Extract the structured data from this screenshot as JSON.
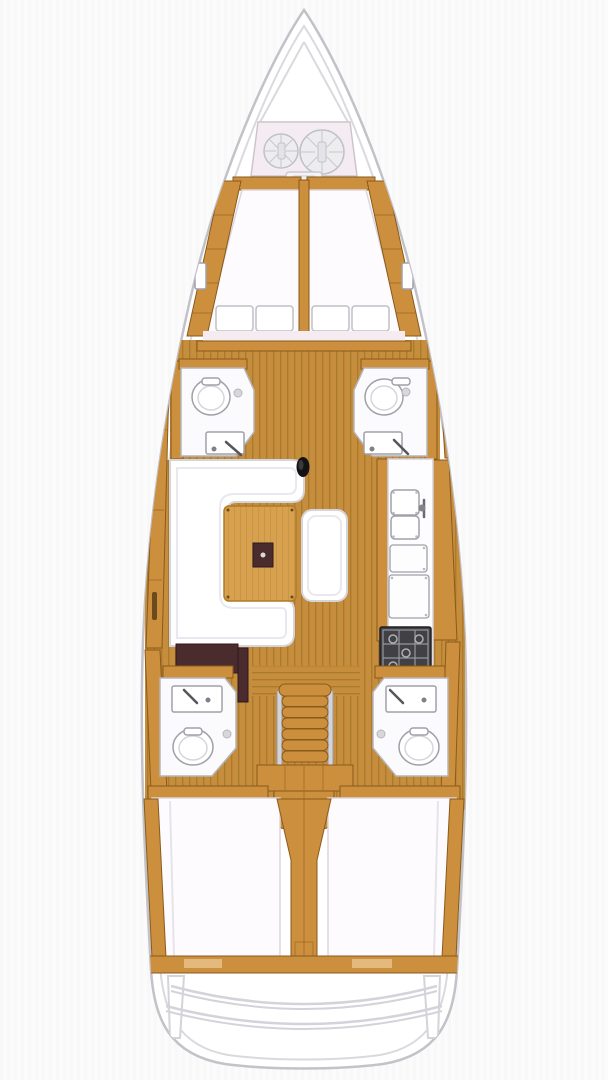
{
  "meta": {
    "label": "Sailboat interior deck plan, top-down view",
    "view": "overhead floor plan",
    "vessel_type": "sailing yacht monohull"
  },
  "colors": {
    "hull_stroke": "#c2c2c8",
    "inner_hull_line": "#d9d9de",
    "wood_trim": "#cc8f3d",
    "wood_dark": "#8a5a1a",
    "wood_light": "#e6c189",
    "floor_wood": "#c68e3c",
    "plank_line": "#a3762c",
    "table_wood": "#d7a150",
    "dark_panel": "#4a2b2e",
    "mattress_white": "#fdfbfd",
    "room_fill": "#fbfafc",
    "room_stroke": "#b5b5bd",
    "fixture_stroke": "#a0a0a8",
    "settee_stroke": "#d4d4da",
    "blush": "#f5ecf2",
    "metal": "#d3d3da",
    "stove_body": "#404045",
    "stove_grate": "#97979e",
    "mast_black": "#131313",
    "coil_fill": "#ededef",
    "coil_stroke": "#c0c0c8"
  },
  "areas": [
    {
      "name": "anchor-locker",
      "label": "Bow anchor locker with two rope coils"
    },
    {
      "name": "v-berth",
      "label": "Forward V-berth double cabin with center divider"
    },
    {
      "name": "forward-head-port",
      "label": "Forward port bathroom with toilet and sink"
    },
    {
      "name": "forward-head-starboard",
      "label": "Forward starboard bathroom with toilet and sink"
    },
    {
      "name": "salon",
      "label": "Main salon with U-shaped settee, wooden table and bench"
    },
    {
      "name": "galley",
      "label": "Starboard galley with double sink, counters and stove"
    },
    {
      "name": "nav-station",
      "label": "Port navigation station with dark chart seat"
    },
    {
      "name": "companionway",
      "label": "Companionway stairs with handrails"
    },
    {
      "name": "aft-head-port",
      "label": "Aft port bathroom with sink and toilet"
    },
    {
      "name": "aft-head-starboard",
      "label": "Aft starboard bathroom with sink and toilet"
    },
    {
      "name": "aft-cabin-port",
      "label": "Aft port double berth cabin"
    },
    {
      "name": "aft-cabin-starboard",
      "label": "Aft starboard double berth cabin"
    },
    {
      "name": "engine-box",
      "label": "Engine compartment under stairs"
    },
    {
      "name": "transom",
      "label": "Stern transom with curved swim-platform steps"
    },
    {
      "name": "mast",
      "label": "Mast foot at salon forward bulkhead"
    }
  ],
  "details": {
    "rope_coils": 2,
    "berth_pillows": 4,
    "stair_treads": 6,
    "bathrooms": 4,
    "sink_modules": 2,
    "counter_panels": 2,
    "stove_burners": 4,
    "transom_curves": 2
  }
}
